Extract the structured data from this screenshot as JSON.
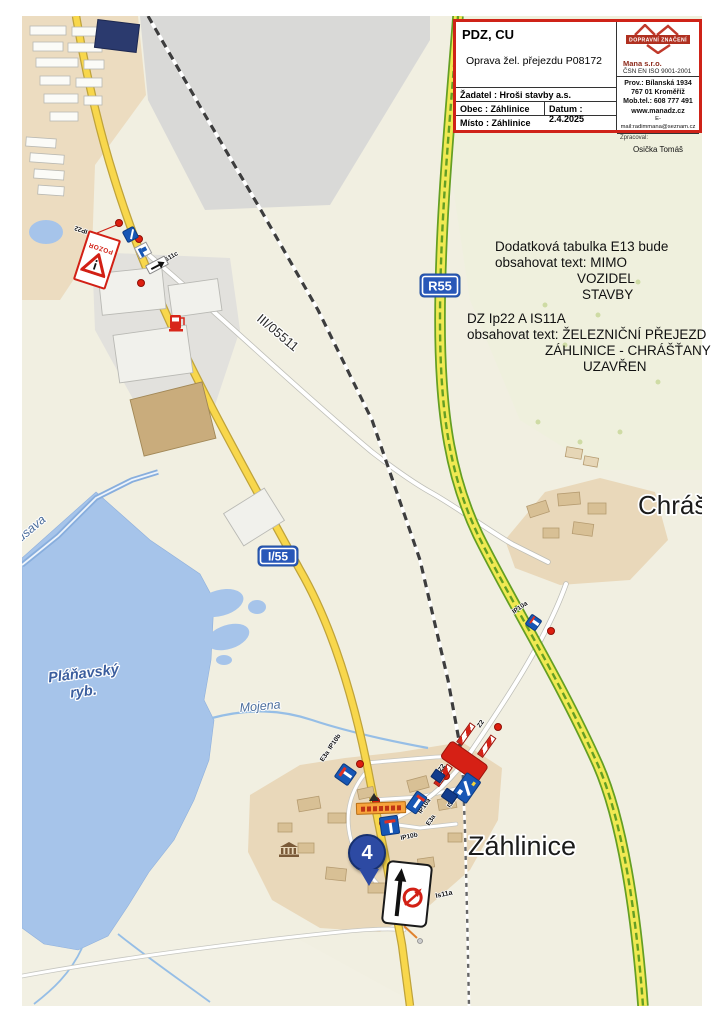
{
  "title_block": {
    "doc_type": "PDZ, CU",
    "doc_title": "Oprava žel. přejezdu P08172",
    "applicant": "Žadatel : Hroši stavby a.s.",
    "municipality": "Obec : Záhlinice",
    "date": "Datum : 2.4.2025",
    "place": "Místo : Záhlinice",
    "logo_text": "DOPRAVNÍ ZNAČENÍ",
    "company": "Mana s.r.o.",
    "iso": "ČSN EN ISO 9001-2001",
    "address1": "Prov.: Bílanská 1934",
    "address2": "767 01 Kroměříž",
    "phone": "Mob.tel.: 608 777 491",
    "web": "www.manadz.cz",
    "email": "E-mail:radimmana@seznam.cz",
    "prepared_label": "Zpracoval:",
    "prepared_by": "Osička Tomáš"
  },
  "annotations": {
    "e13": {
      "l1": "Dodatková tabulka E13 bude",
      "l2": "obsahovat text:  MIMO",
      "l3": "VOZIDEL",
      "l4": "STAVBY"
    },
    "dz": {
      "l1": "DZ Ip22 A IS11A",
      "l2": "obsahovat text:  ŽELEZNIČNÍ PŘEJEZD",
      "l3": "ZÁHLINICE - CHRÁŠŤANY",
      "l4": "UZAVŘEN"
    }
  },
  "map": {
    "shield_r55": "R55",
    "shield_i55": "I/55",
    "road_iii": "III/05511",
    "place_zahlinice": "Záhlinice",
    "place_chrastany": "Chrášťany",
    "pond_line1": "Pláňavský",
    "pond_line2": "ryb.",
    "river_rusava": "Rusava",
    "stream_mojena": "Mojena",
    "marker_number": "4",
    "signs": {
      "ip22_label": "IP22",
      "pozor": "POZOR",
      "is11c_label": "IS11c",
      "z2_label_a": "Z2",
      "z2_label_b": "Z2",
      "is11b_label": "IS11b",
      "ip10a_label_a": "IP10a",
      "ip10a_label_b": "IP10a",
      "ip10b_label_a": "IP10b",
      "ip10b_label_b": "IP10b",
      "e3a_label_a": "E3a",
      "e3a_label_b": "E3a",
      "is11a_label": "Is11a"
    },
    "colors": {
      "accent_red": "#cf2318",
      "sign_blue": "#1757b5",
      "shield_blue": "#2857b8",
      "water": "#a6c4ea",
      "primary_road": "#f8d74c",
      "expressway_green": "#649f24"
    }
  }
}
